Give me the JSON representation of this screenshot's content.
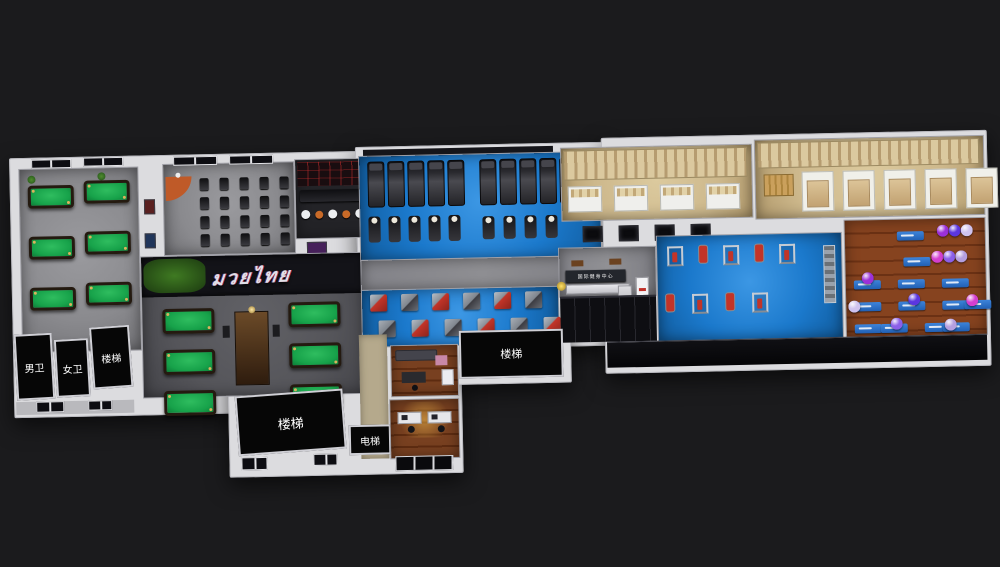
{
  "rooms": {
    "mens_wc": {
      "label": "男卫"
    },
    "womens_wc": {
      "label": "女卫"
    },
    "stairs_left": {
      "label": "楼梯"
    },
    "stairs_center": {
      "label": "楼梯"
    },
    "stairs_right": {
      "label": "楼梯"
    },
    "elevator": {
      "label": "电梯"
    }
  },
  "mural": {
    "text": "มวยไทย"
  },
  "reception": {
    "sign_text": "国际健身中心"
  },
  "equipment": {
    "pool_tables_front_room": 6,
    "pool_tables_main_hall": 6,
    "treadmills": 10,
    "ellipticals": 5,
    "exercise_bikes": 4,
    "spin_bikes": 20,
    "strength_machines": 12,
    "free_weight_stations": 9,
    "bar_tables": 5,
    "bar_stools": 4,
    "wall_posters": 4,
    "locker_bays": 4,
    "shower_stalls": 5,
    "yoga_mats": 13,
    "exercise_balls": 12
  },
  "palette": {
    "background": "#1b1b1d",
    "wall": "#dcdcdf",
    "floor_gray": "#8a8a8e",
    "floor_dark": "#55555a",
    "floor_blue": "#1b79cc",
    "floor_wood": "#7c3d1f",
    "floor_office": "#6e3418",
    "locker_tan": "#cdb88c",
    "table_green": "#17a24a",
    "accent_red": "#c23428",
    "accent_orange": "#c86a28",
    "black_room": "#060606",
    "ball_colors": [
      "#9b30d8",
      "#5b36e0",
      "#cfc2ee",
      "#d43fd0",
      "#8b5fe8",
      "#b49fe0"
    ]
  }
}
